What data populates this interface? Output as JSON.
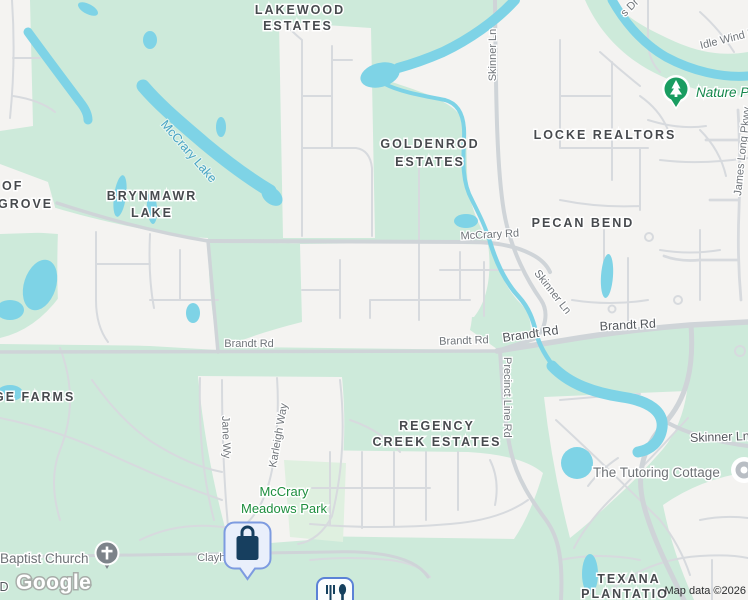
{
  "app": "map-view",
  "localities": [
    {
      "lines": [
        "LAKEWOOD",
        "ESTATES"
      ]
    },
    {
      "lines": [
        "GOLDENROD",
        "ESTATES"
      ]
    },
    {
      "lines": [
        "LOCKE REALTORS"
      ]
    },
    {
      "lines": [
        "PECAN BEND"
      ]
    },
    {
      "lines": [
        "BRYNMAWR",
        "LAKE"
      ]
    },
    {
      "lines": [
        "OF",
        "GROVE"
      ]
    },
    {
      "lines": [
        "GE FARMS"
      ]
    },
    {
      "lines": [
        "REGENCY",
        "CREEK ESTATES"
      ]
    },
    {
      "lines": [
        "TEXANA",
        "PLANTATIO"
      ]
    }
  ],
  "roads": {
    "mccrary": "McCrary Rd",
    "brandt": "Brandt Rd",
    "skinner": "Skinner Ln",
    "precinct": "Precinct Line Rd",
    "jane": "Jane Wy",
    "karleigh": "Karleigh Way",
    "idle_wind": "Idle Wind D",
    "s_dr": "s Dr",
    "james_long": "James Long Pkwy",
    "clayhead": "Clayhead Rd",
    "d_partial": "D"
  },
  "water_labels": {
    "mccrary_lake": "McCrary Lake"
  },
  "pois": {
    "baptist_church": "Baptist Church",
    "tutoring": "The Tutoring Cottage",
    "nature_preserve": "Nature Pr",
    "park_line1": "McCrary",
    "park_line2": "Meadows Park"
  },
  "icons": {
    "selected_marker": "shopping-bag-icon",
    "church": "church-cross-icon",
    "nature": "pine-tree-icon",
    "generic_poi": "dot-icon",
    "restaurant": "fork-spoon-icon"
  },
  "attribution": {
    "logo": "Google",
    "map_data": "Map data ©2026"
  },
  "colors": {
    "vegetation": "#cdeada",
    "park": "#dff0e0",
    "water": "#7ed3e6",
    "residential": "#f4f3f1",
    "road_minor": "#d7dade",
    "road_main": "#cfd4d8",
    "locality_label": "#474a4e",
    "road_label": "#70757a",
    "road_label_major": "#54585d",
    "park_label": "#1e8e3e",
    "water_label": "#48a3c4",
    "poi_label": "#6e7276",
    "nature_label": "#14874b",
    "marker_fill": "#e9effb",
    "marker_border": "#7d9be0",
    "marker_glyph": "#173f5f",
    "church_pin": "#7d838a",
    "nature_pin": "#1a9d61"
  }
}
